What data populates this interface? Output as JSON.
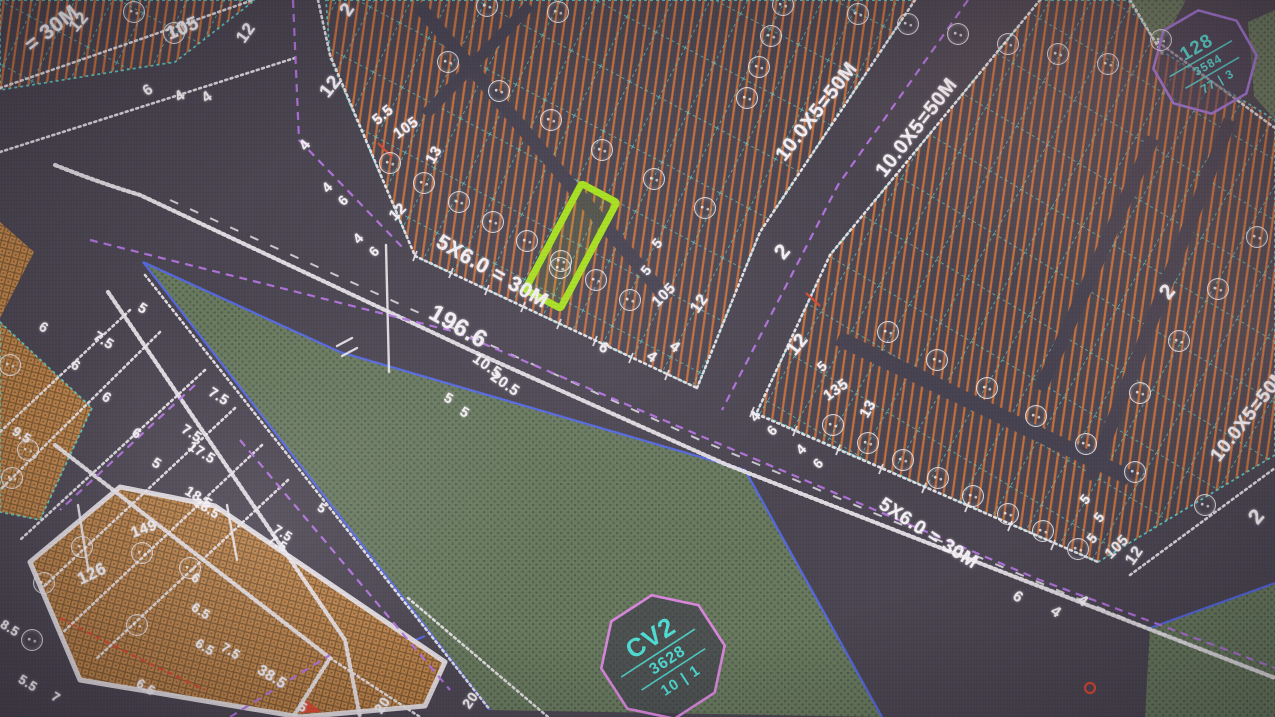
{
  "colors": {
    "bg": "#4a4550",
    "lane": "#474250",
    "hatch": "#c9703a",
    "cyan": "#5fded6",
    "white_line": "#eae6ec",
    "text": "#f3eff4",
    "purple": "#b473e0",
    "park": "#68795e",
    "park_dark": "#50604a",
    "brick": "#bf8348",
    "brick_dark": "#7d5a33",
    "blue": "#5468e8",
    "red": "#d84a30",
    "highlight": "#a6e01c",
    "badge_cyan": "#4fdcd4",
    "badge_border_park": "#d887dc",
    "badge_border_blk": "#a174d8"
  },
  "park_badge": {
    "name": "CV2",
    "area": "3628",
    "ratio": "10 | 1"
  },
  "block_badge": {
    "name": "128",
    "area": "3584",
    "ratio": "77 | 3"
  },
  "highlighted_plot": {
    "x": 571,
    "y": 246,
    "w": 40,
    "h": 120,
    "rot": 28
  },
  "labels": [
    {
      "t": "= 30M",
      "x": 52,
      "y": 29,
      "r": -38,
      "s": 21
    },
    {
      "t": "12",
      "x": 79,
      "y": 22,
      "r": -50,
      "s": 17
    },
    {
      "t": "105",
      "x": 183,
      "y": 29,
      "r": -22,
      "s": 19
    },
    {
      "t": "12",
      "x": 246,
      "y": 33,
      "r": -55,
      "s": 17
    },
    {
      "t": "6",
      "x": 148,
      "y": 90,
      "r": -35,
      "s": 15
    },
    {
      "t": "4",
      "x": 180,
      "y": 96,
      "r": -35,
      "s": 15
    },
    {
      "t": "4",
      "x": 207,
      "y": 97,
      "r": -35,
      "s": 15
    },
    {
      "t": "2",
      "x": 348,
      "y": 10,
      "r": -55,
      "s": 19
    },
    {
      "t": "12",
      "x": 331,
      "y": 87,
      "r": -52,
      "s": 19
    },
    {
      "t": "4",
      "x": 305,
      "y": 145,
      "r": -50,
      "s": 15
    },
    {
      "t": "4",
      "x": 327,
      "y": 187,
      "r": -45,
      "s": 14
    },
    {
      "t": "6",
      "x": 343,
      "y": 200,
      "r": -45,
      "s": 14
    },
    {
      "t": "4",
      "x": 358,
      "y": 238,
      "r": -45,
      "s": 14
    },
    {
      "t": "6",
      "x": 374,
      "y": 251,
      "r": -45,
      "s": 14
    },
    {
      "t": "12",
      "x": 398,
      "y": 212,
      "r": -45,
      "s": 15
    },
    {
      "t": "5.5",
      "x": 383,
      "y": 115,
      "r": -40,
      "s": 15
    },
    {
      "t": "105",
      "x": 406,
      "y": 128,
      "r": -35,
      "s": 15
    },
    {
      "t": "13",
      "x": 434,
      "y": 155,
      "r": -60,
      "s": 15
    },
    {
      "t": "5",
      "x": 657,
      "y": 243,
      "r": -50,
      "s": 14
    },
    {
      "t": "5",
      "x": 646,
      "y": 270,
      "r": -50,
      "s": 14
    },
    {
      "t": "105",
      "x": 664,
      "y": 295,
      "r": -45,
      "s": 15
    },
    {
      "t": "12",
      "x": 700,
      "y": 304,
      "r": -55,
      "s": 16
    },
    {
      "t": "6",
      "x": 604,
      "y": 348,
      "r": 35,
      "s": 15
    },
    {
      "t": "4",
      "x": 652,
      "y": 357,
      "r": 35,
      "s": 15
    },
    {
      "t": "4",
      "x": 675,
      "y": 347,
      "r": 35,
      "s": 15
    },
    {
      "t": "5X6.0 = 30M",
      "x": 492,
      "y": 272,
      "r": 30,
      "s": 21
    },
    {
      "t": "196.6",
      "x": 458,
      "y": 327,
      "r": 30,
      "s": 24
    },
    {
      "t": "10.5",
      "x": 487,
      "y": 366,
      "r": 35,
      "s": 15
    },
    {
      "t": "20.5",
      "x": 505,
      "y": 384,
      "r": 35,
      "s": 15
    },
    {
      "t": "5",
      "x": 449,
      "y": 398,
      "r": 30,
      "s": 14
    },
    {
      "t": "5",
      "x": 465,
      "y": 412,
      "r": 30,
      "s": 14
    },
    {
      "t": "10.0X5=50M",
      "x": 817,
      "y": 112,
      "r": -52,
      "s": 20
    },
    {
      "t": "10.0X5=50M",
      "x": 917,
      "y": 128,
      "r": -52,
      "s": 20
    },
    {
      "t": "2",
      "x": 783,
      "y": 252,
      "r": -50,
      "s": 21
    },
    {
      "t": "12",
      "x": 798,
      "y": 345,
      "r": -52,
      "s": 19
    },
    {
      "t": "4",
      "x": 755,
      "y": 416,
      "r": -45,
      "s": 14
    },
    {
      "t": "6",
      "x": 772,
      "y": 430,
      "r": -45,
      "s": 14
    },
    {
      "t": "4",
      "x": 801,
      "y": 449,
      "r": -45,
      "s": 14
    },
    {
      "t": "6",
      "x": 818,
      "y": 463,
      "r": -45,
      "s": 14
    },
    {
      "t": "5",
      "x": 822,
      "y": 366,
      "r": -40,
      "s": 14
    },
    {
      "t": "135",
      "x": 836,
      "y": 390,
      "r": -35,
      "s": 15
    },
    {
      "t": "13",
      "x": 868,
      "y": 409,
      "r": -60,
      "s": 15
    },
    {
      "t": "5X6.0 = 30M",
      "x": 928,
      "y": 534,
      "r": 33,
      "s": 19
    },
    {
      "t": "6",
      "x": 1018,
      "y": 597,
      "r": 35,
      "s": 15
    },
    {
      "t": "4",
      "x": 1056,
      "y": 612,
      "r": 35,
      "s": 15
    },
    {
      "t": "4",
      "x": 1083,
      "y": 601,
      "r": 35,
      "s": 15
    },
    {
      "t": "5",
      "x": 1085,
      "y": 499,
      "r": -50,
      "s": 14
    },
    {
      "t": "5",
      "x": 1099,
      "y": 517,
      "r": -50,
      "s": 14
    },
    {
      "t": "5",
      "x": 1092,
      "y": 538,
      "r": -50,
      "s": 14
    },
    {
      "t": "105",
      "x": 1117,
      "y": 547,
      "r": -45,
      "s": 15
    },
    {
      "t": "12",
      "x": 1135,
      "y": 556,
      "r": -55,
      "s": 16
    },
    {
      "t": "2",
      "x": 1168,
      "y": 292,
      "r": -50,
      "s": 21
    },
    {
      "t": "2",
      "x": 1257,
      "y": 517,
      "r": -50,
      "s": 21
    },
    {
      "t": "10.0X5=50M",
      "x": 1250,
      "y": 415,
      "r": -52,
      "s": 19
    },
    {
      "t": "5",
      "x": 143,
      "y": 308,
      "r": 32,
      "s": 14
    },
    {
      "t": "7.5",
      "x": 104,
      "y": 340,
      "r": 32,
      "s": 14
    },
    {
      "t": "6",
      "x": 44,
      "y": 327,
      "r": 32,
      "s": 14
    },
    {
      "t": "6",
      "x": 76,
      "y": 365,
      "r": 32,
      "s": 14
    },
    {
      "t": "6",
      "x": 107,
      "y": 397,
      "r": 32,
      "s": 14
    },
    {
      "t": "6",
      "x": 137,
      "y": 433,
      "r": 32,
      "s": 14
    },
    {
      "t": "5",
      "x": 157,
      "y": 463,
      "r": 32,
      "s": 14
    },
    {
      "t": "7.5",
      "x": 192,
      "y": 433,
      "r": 32,
      "s": 14
    },
    {
      "t": "17.5",
      "x": 202,
      "y": 452,
      "r": 32,
      "s": 14
    },
    {
      "t": "7.5",
      "x": 219,
      "y": 396,
      "r": 32,
      "s": 14
    },
    {
      "t": "18.5",
      "x": 199,
      "y": 497,
      "r": 32,
      "s": 14
    },
    {
      "t": "9.5",
      "x": 22,
      "y": 435,
      "r": 32,
      "s": 13
    },
    {
      "t": "8.5",
      "x": 10,
      "y": 628,
      "r": 32,
      "s": 13
    },
    {
      "t": "149",
      "x": 144,
      "y": 529,
      "r": -20,
      "s": 15
    },
    {
      "t": "126",
      "x": 92,
      "y": 574,
      "r": -25,
      "s": 17
    },
    {
      "t": "18.5",
      "x": 207,
      "y": 508,
      "r": 32,
      "s": 13
    },
    {
      "t": "6",
      "x": 196,
      "y": 578,
      "r": 32,
      "s": 13
    },
    {
      "t": "6.5",
      "x": 201,
      "y": 611,
      "r": 32,
      "s": 13
    },
    {
      "t": "7.5",
      "x": 231,
      "y": 651,
      "r": 32,
      "s": 13
    },
    {
      "t": "38.5",
      "x": 272,
      "y": 677,
      "r": 32,
      "s": 15
    },
    {
      "t": "5.5",
      "x": 28,
      "y": 683,
      "r": 32,
      "s": 13
    },
    {
      "t": "7",
      "x": 56,
      "y": 697,
      "r": 32,
      "s": 13
    },
    {
      "t": "6.5",
      "x": 146,
      "y": 687,
      "r": 32,
      "s": 13
    },
    {
      "t": "7.5",
      "x": 283,
      "y": 533,
      "r": 32,
      "s": 13
    },
    {
      "t": "5",
      "x": 322,
      "y": 508,
      "r": 32,
      "s": 13
    },
    {
      "t": "7.5",
      "x": 278,
      "y": 543,
      "r": 32,
      "s": 13
    },
    {
      "t": "6.5",
      "x": 205,
      "y": 647,
      "r": 32,
      "s": 13
    },
    {
      "t": "20",
      "x": 382,
      "y": 705,
      "r": -55,
      "s": 14
    },
    {
      "t": "20",
      "x": 470,
      "y": 700,
      "r": -55,
      "s": 14
    },
    {
      "t": "5",
      "x": 303,
      "y": 707,
      "r": 30,
      "s": 13
    }
  ],
  "plot_marker_rows": [
    {
      "x1": 390,
      "y1": 163,
      "x2": 630,
      "y2": 300,
      "n": 8
    },
    {
      "x1": 448,
      "y1": 62,
      "x2": 705,
      "y2": 208,
      "n": 6
    },
    {
      "x1": 747,
      "y1": 98,
      "x2": 783,
      "y2": 5,
      "n": 4
    },
    {
      "x1": 134,
      "y1": 12,
      "x2": 174,
      "y2": 33,
      "n": 2
    },
    {
      "x1": 858,
      "y1": 14,
      "x2": 1108,
      "y2": 64,
      "n": 6
    },
    {
      "x1": 888,
      "y1": 332,
      "x2": 1135,
      "y2": 472,
      "n": 6
    },
    {
      "x1": 833,
      "y1": 425,
      "x2": 1078,
      "y2": 549,
      "n": 8
    },
    {
      "x1": 1257,
      "y1": 237,
      "x2": 1140,
      "y2": 393,
      "n": 4
    }
  ],
  "plot_markers": [
    {
      "x": 560,
      "y": 268
    },
    {
      "x": 487,
      "y": 6
    },
    {
      "x": 558,
      "y": 12
    },
    {
      "x": 1161,
      "y": 40
    },
    {
      "x": 82,
      "y": 547
    },
    {
      "x": 44,
      "y": 583
    },
    {
      "x": 32,
      "y": 640
    },
    {
      "x": 142,
      "y": 553
    },
    {
      "x": 137,
      "y": 625
    },
    {
      "x": 190,
      "y": 568
    },
    {
      "x": 10,
      "y": 365
    },
    {
      "x": 28,
      "y": 450
    },
    {
      "x": 12,
      "y": 478
    },
    {
      "x": 1205,
      "y": 505
    }
  ]
}
